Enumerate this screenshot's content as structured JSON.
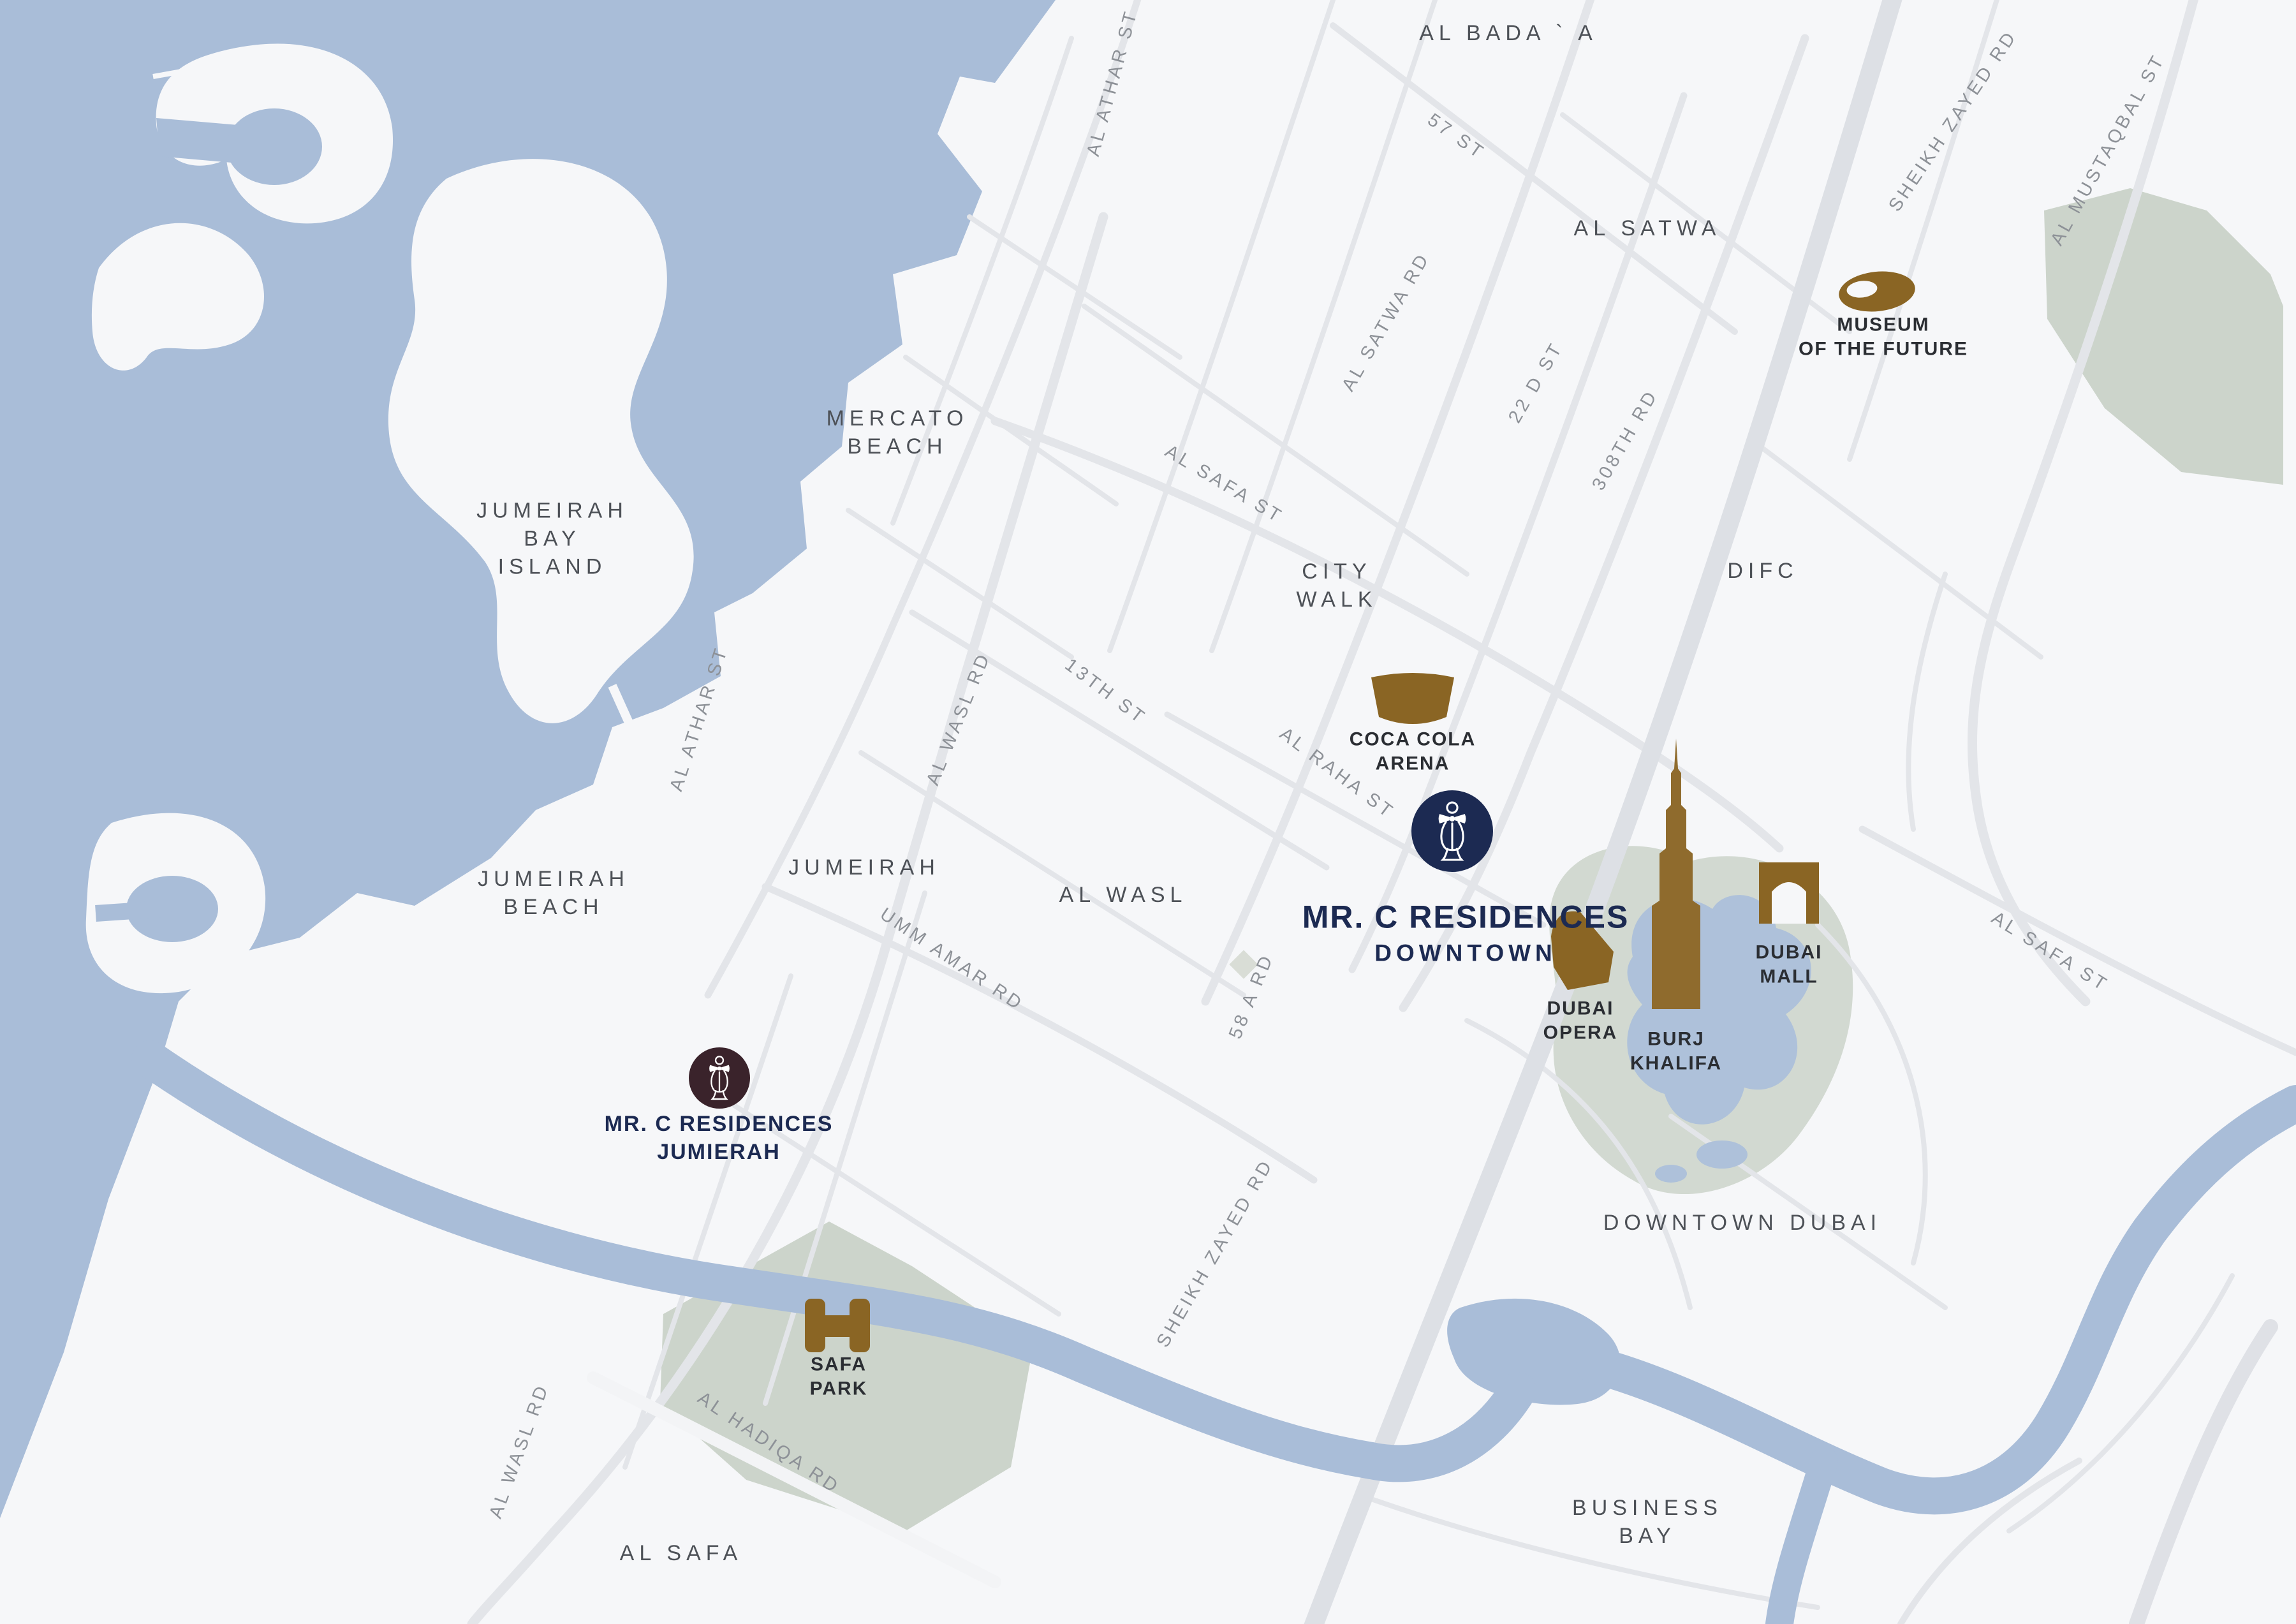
{
  "colors": {
    "water": "#a9bdd8",
    "land": "#f6f7f9",
    "park": "#ccd4cb",
    "road": "#e3e5e9",
    "road_major": "#dde0e5",
    "gold": "#8a6524",
    "navy": "#1c2a52",
    "maroon": "#3a232b",
    "poi_text": "#2b2e33",
    "district_text": "#4d5157",
    "street_text": "#8d9197"
  },
  "districts": {
    "al_bada": "AL BADA ` A",
    "al_satwa": "AL SATWA",
    "mercato_beach": [
      "MERCATO",
      "BEACH"
    ],
    "jumeirah_bay_island": [
      "JUMEIRAH",
      "BAY",
      "ISLAND"
    ],
    "city_walk": [
      "CITY",
      "WALK"
    ],
    "difc": "DIFC",
    "jumeirah": "JUMEIRAH",
    "al_wasl": "AL WASL",
    "jumeirah_beach": [
      "JUMEIRAH",
      "BEACH"
    ],
    "downtown_dubai": "DOWNTOWN DUBAI",
    "business_bay": [
      "BUSINESS",
      "BAY"
    ],
    "al_safa": "AL SAFA"
  },
  "streets": {
    "st_57": "57 ST",
    "al_athar_st": "AL ATHAR ST",
    "sheikh_zayed_rd": "SHEIKH ZAYED RD",
    "al_mustaqbal_st": "AL MUSTAQBAL ST",
    "al_satwa_rd": "AL SATWA RD",
    "st_22_d": "22 D ST",
    "rd_308th": "308TH RD",
    "al_safa_st": "AL SAFA ST",
    "st_13th": "13TH ST",
    "al_raha_st": "AL RAHA ST",
    "al_wasl_rd": "AL WASL RD",
    "umm_amar_rd": "UMM AMAR RD",
    "rd_58_a": "58 A RD",
    "al_hadiqa_rd": "AL HADIQA RD"
  },
  "pois": {
    "museum_of_the_future": {
      "label": [
        "MUSEUM",
        "OF THE FUTURE"
      ],
      "icon": "museum-torus-icon"
    },
    "coca_cola_arena": {
      "label": [
        "COCA COLA",
        "ARENA"
      ],
      "icon": "arena-bowl-icon"
    },
    "mr_c_residences_downtown": {
      "title": "MR. C RESIDENCES",
      "subtitle": "DOWNTOWN",
      "icon": "mr-c-figure-icon",
      "marker_color": "#1c2a52"
    },
    "burj_khalifa": {
      "label": [
        "BURJ",
        "KHALIFA"
      ],
      "icon": "burj-khalifa-spire-icon"
    },
    "dubai_mall": {
      "label": [
        "DUBAI",
        "MALL"
      ],
      "icon": "arch-gate-icon"
    },
    "dubai_opera": {
      "label": [
        "DUBAI",
        "OPERA"
      ],
      "icon": "opera-sail-icon"
    },
    "mr_c_residences_jumierah": {
      "label": [
        "MR. C RESIDENCES",
        "JUMIERAH"
      ],
      "icon": "mr-c-figure-icon",
      "marker_color": "#3a232b"
    },
    "safa_park": {
      "label": [
        "SAFA",
        "PARK"
      ],
      "icon": "park-gate-icon"
    }
  }
}
